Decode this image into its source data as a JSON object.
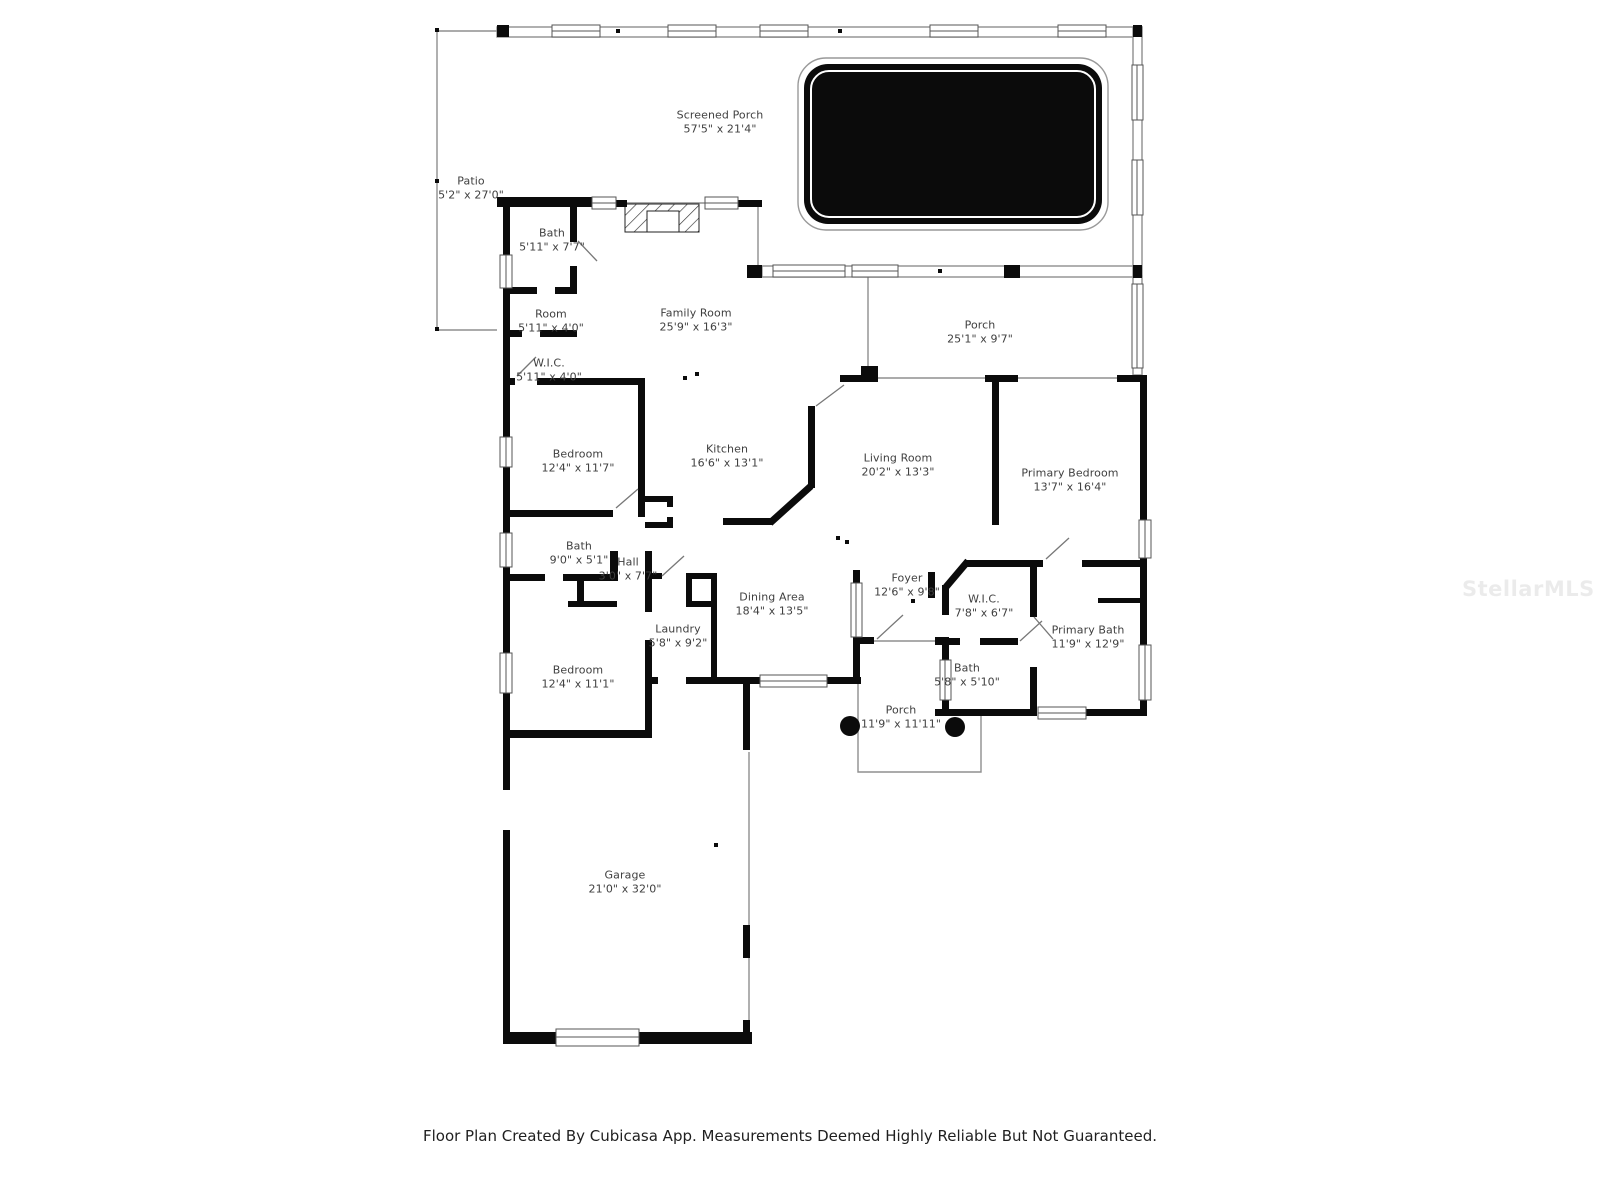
{
  "watermark": {
    "text": "StellarMLS",
    "color": "rgba(0,0,0,0.08)"
  },
  "footer": {
    "text": "Floor Plan Created By Cubicasa App. Measurements Deemed Highly Reliable But Not Guaranteed."
  },
  "floor_plan": {
    "wall_color": "#0b0b0b",
    "thin_line_color": "#8f8f8f",
    "label_color": "#3f3f3f",
    "pool_color": "#0b0b0b",
    "rooms": [
      {
        "id": "screened-porch",
        "name": "Screened Porch",
        "dimensions": "57'5\" x 21'4\"",
        "x": 720,
        "y": 122
      },
      {
        "id": "patio",
        "name": "Patio",
        "dimensions": "5'2\" x 27'0\"",
        "x": 471,
        "y": 188
      },
      {
        "id": "bath-1",
        "name": "Bath",
        "dimensions": "5'11\" x 7'7\"",
        "x": 552,
        "y": 240
      },
      {
        "id": "room",
        "name": "Room",
        "dimensions": "5'11\" x 4'0\"",
        "x": 551,
        "y": 321
      },
      {
        "id": "wic-1",
        "name": "W.I.C.",
        "dimensions": "5'11\" x 4'0\"",
        "x": 549,
        "y": 370
      },
      {
        "id": "family-room",
        "name": "Family Room",
        "dimensions": "25'9\" x 16'3\"",
        "x": 696,
        "y": 320
      },
      {
        "id": "porch-1",
        "name": "Porch",
        "dimensions": "25'1\" x 9'7\"",
        "x": 980,
        "y": 332
      },
      {
        "id": "bedroom-1",
        "name": "Bedroom",
        "dimensions": "12'4\" x 11'7\"",
        "x": 578,
        "y": 461
      },
      {
        "id": "kitchen",
        "name": "Kitchen",
        "dimensions": "16'6\" x 13'1\"",
        "x": 727,
        "y": 456
      },
      {
        "id": "living-room",
        "name": "Living Room",
        "dimensions": "20'2\" x 13'3\"",
        "x": 898,
        "y": 465
      },
      {
        "id": "primary-bedroom",
        "name": "Primary Bedroom",
        "dimensions": "13'7\" x 16'4\"",
        "x": 1070,
        "y": 480
      },
      {
        "id": "bath-2",
        "name": "Bath",
        "dimensions": "9'0\" x 5'1\"",
        "x": 579,
        "y": 553
      },
      {
        "id": "hall",
        "name": "Hall",
        "dimensions": "3'0\" x 7'7\"",
        "x": 628,
        "y": 569
      },
      {
        "id": "dining-area",
        "name": "Dining Area",
        "dimensions": "18'4\" x 13'5\"",
        "x": 772,
        "y": 604
      },
      {
        "id": "foyer",
        "name": "Foyer",
        "dimensions": "12'6\" x 9'8\"",
        "x": 907,
        "y": 585
      },
      {
        "id": "wic-2",
        "name": "W.I.C.",
        "dimensions": "7'8\" x 6'7\"",
        "x": 984,
        "y": 606
      },
      {
        "id": "primary-bath",
        "name": "Primary Bath",
        "dimensions": "11'9\" x 12'9\"",
        "x": 1088,
        "y": 637
      },
      {
        "id": "laundry",
        "name": "Laundry",
        "dimensions": "5'8\" x 9'2\"",
        "x": 678,
        "y": 636
      },
      {
        "id": "bath-3",
        "name": "Bath",
        "dimensions": "5'8\" x 5'10\"",
        "x": 967,
        "y": 675
      },
      {
        "id": "bedroom-2",
        "name": "Bedroom",
        "dimensions": "12'4\" x 11'1\"",
        "x": 578,
        "y": 677
      },
      {
        "id": "porch-2",
        "name": "Porch",
        "dimensions": "11'9\" x 11'11\"",
        "x": 901,
        "y": 717
      },
      {
        "id": "garage",
        "name": "Garage",
        "dimensions": "21'0\" x 32'0\"",
        "x": 625,
        "y": 882
      }
    ]
  }
}
